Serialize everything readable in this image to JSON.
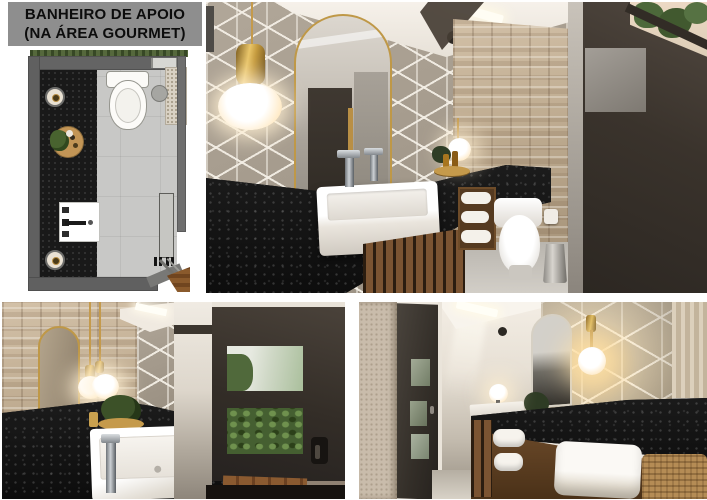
{
  "title": {
    "line1": "BANHEIRO DE APOIO",
    "line2": "(NA ÁREA GOURMET)"
  },
  "palette": {
    "page_background": "#ffffff",
    "title_background": "#8e8e8e",
    "title_text": "#0c0c0c",
    "granite_countertop": "#141414",
    "geometric_wallpaper": "#a2988a",
    "stone_wall": "#c3b096",
    "brass_gold": "#c49a4c",
    "wood_slats": "#7b5432",
    "door_dark": "#332d27",
    "plan_floor": "#c8c8c6",
    "plan_countertop": "#191919",
    "plan_wall": "#646464",
    "ceiling": "#f6f1ea",
    "foliage_green": "#4c683a",
    "towel_white": "#f6f3ed"
  }
}
